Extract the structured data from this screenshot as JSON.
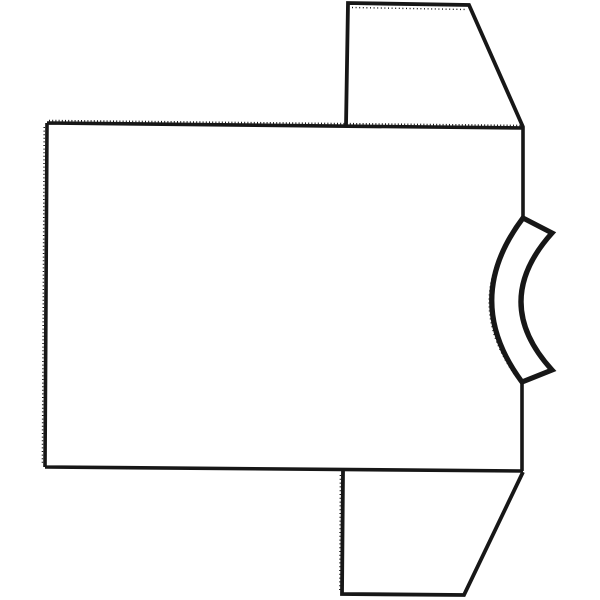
{
  "page": {
    "background_color": "#ffffff"
  },
  "drawing": {
    "description": "Black outline line drawing of a short-sleeve T-shirt rotated 90 degrees (lying on its side): large body panel rectangle on the left, trapezoidal sleeves extending from the top-right and bottom-right, and a thick curved neckband collar bowing inward on the right edge between the sleeves. Hand-drawn scanned look with stitch-like serrated texture on the shoulder and hem edges.",
    "canvas": {
      "width": 600,
      "height": 600
    },
    "stroke_color": "#171717",
    "background_color": "#ffffff",
    "shapes": [
      {
        "name": "body-panel-outline",
        "type": "path",
        "d": "M47 123 L523 128 L523 218 M522 383 L522 471 M45 467 L523 471 M47 123 L45 467",
        "stroke_width": 3.6,
        "fill": "none"
      },
      {
        "name": "top-sleeve-outline",
        "type": "polyline",
        "points": [
          [
            346,
            126
          ],
          [
            348,
            3
          ],
          [
            469,
            5
          ],
          [
            523,
            127
          ]
        ],
        "stroke_width": 3.8,
        "fill": "none"
      },
      {
        "name": "bottom-sleeve-outline",
        "type": "polyline",
        "points": [
          [
            343,
            471
          ],
          [
            342,
            594
          ],
          [
            464,
            595
          ],
          [
            523,
            472
          ]
        ],
        "stroke_width": 3.8,
        "fill": "none"
      },
      {
        "name": "collar-neckband",
        "type": "path",
        "d": "M523 218 L552 233 Q490 302 552 370 L522 382 Q461 300 523 218 Z",
        "stroke_width": 5.2,
        "fill": "#ffffff"
      },
      {
        "name": "shoulder-edge-stitch-texture",
        "type": "path",
        "d": "M49 120.6 L521 125.6",
        "stroke_width": 1.8,
        "dash": "1 2.2",
        "fill": "none"
      },
      {
        "name": "left-hem-stitch-texture",
        "type": "path",
        "d": "M44.2 127 L42.4 464",
        "stroke_width": 1.5,
        "dash": "1 2.6",
        "fill": "none"
      },
      {
        "name": "bottom-sleeve-left-stitch-texture",
        "type": "path",
        "d": "M340.4 475 L339.8 592",
        "stroke_width": 1.5,
        "dash": "1 2.8",
        "fill": "none"
      },
      {
        "name": "top-sleeve-top-stitch-texture",
        "type": "path",
        "d": "M352 7.5 L466 9.5",
        "stroke_width": 1.4,
        "dash": "1 2.6",
        "fill": "none"
      },
      {
        "name": "collar-outer-rough-texture",
        "type": "path",
        "d": "M520.5 222 Q459.5 300 517 378",
        "stroke_width": 1.4,
        "dash": "1 3",
        "fill": "none"
      },
      {
        "name": "collar-inner-rough-texture",
        "type": "path",
        "d": "M549.5 236 Q492.5 302 549.5 366",
        "stroke_width": 1.4,
        "dash": "1 3",
        "fill": "none"
      }
    ]
  }
}
